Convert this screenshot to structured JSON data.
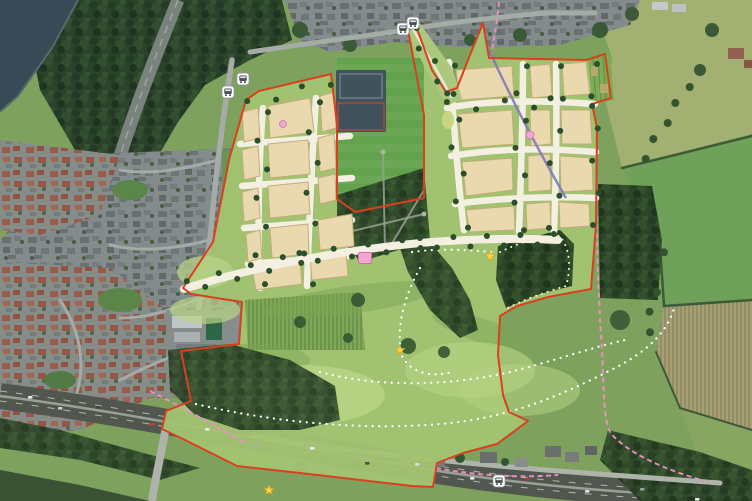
{
  "map": {
    "colors": {
      "site_boundary": "#d8401f",
      "proposed_footpath": "#ffffff",
      "existing_footpath": "#ef8fc2",
      "bridleway": "#8379b8",
      "development_parcel": "#ead9ae",
      "open_space": "#a3c471",
      "street_tree": "#2c4f2b",
      "play_area": "#f0a8d0",
      "viewpoint_star": "#f7d345"
    },
    "markers": {
      "bus_stops": [
        {
          "x": 243,
          "y": 79
        },
        {
          "x": 228,
          "y": 92
        },
        {
          "x": 403,
          "y": 29
        },
        {
          "x": 413,
          "y": 23
        },
        {
          "x": 499,
          "y": 481
        }
      ],
      "viewpoint_stars": [
        {
          "x": 490,
          "y": 256
        },
        {
          "x": 400,
          "y": 350
        },
        {
          "x": 269,
          "y": 490
        }
      ],
      "play_areas": [
        {
          "shape": "square",
          "x": 365,
          "y": 258,
          "w": 13,
          "h": 11
        },
        {
          "shape": "circle",
          "x": 530,
          "y": 135,
          "r": 4
        },
        {
          "shape": "circle",
          "x": 283,
          "y": 124,
          "r": 3.5
        }
      ]
    },
    "tree_lines": [
      {
        "x1": 188,
        "y1": 286,
        "x2": 300,
        "y2": 258,
        "n": 8,
        "s": 5
      },
      {
        "x1": 300,
        "y1": 258,
        "x2": 420,
        "y2": 243,
        "n": 8,
        "s": 5
      },
      {
        "x1": 420,
        "y1": 243,
        "x2": 554,
        "y2": 239,
        "n": 9,
        "s": 5
      },
      {
        "x1": 413,
        "y1": 30,
        "x2": 450,
        "y2": 96,
        "n": 5,
        "s": 4
      },
      {
        "x1": 263,
        "y1": 112,
        "x2": 260,
        "y2": 284,
        "n": 7,
        "s": 5
      },
      {
        "x1": 315,
        "y1": 102,
        "x2": 308,
        "y2": 284,
        "n": 7,
        "s": 5
      },
      {
        "x1": 248,
        "y1": 104,
        "x2": 330,
        "y2": 82,
        "n": 4,
        "s": 3
      },
      {
        "x1": 450,
        "y1": 66,
        "x2": 463,
        "y2": 228,
        "n": 7,
        "s": 5
      },
      {
        "x1": 522,
        "y1": 66,
        "x2": 519,
        "y2": 230,
        "n": 7,
        "s": 5
      },
      {
        "x1": 556,
        "y1": 66,
        "x2": 554,
        "y2": 228,
        "n": 6,
        "s": 5
      },
      {
        "x1": 447,
        "y1": 106,
        "x2": 592,
        "y2": 102,
        "n": 6,
        "s": 4
      },
      {
        "x1": 594,
        "y1": 64,
        "x2": 596,
        "y2": 225,
        "n": 6,
        "s": 3
      },
      {
        "x1": 688,
        "y1": 86,
        "x2": 644,
        "y2": 158,
        "n": 5,
        "s": 2,
        "r": 4,
        "c": "#35532f"
      },
      {
        "x1": 662,
        "y1": 252,
        "x2": 648,
        "y2": 332,
        "n": 5,
        "s": 2,
        "r": 4,
        "c": "#35532f"
      }
    ],
    "cars": [
      {
        "x": 28,
        "y": 399,
        "c": "#e8eae9"
      },
      {
        "x": 58,
        "y": 404,
        "c": "#c8cbca"
      },
      {
        "x": 96,
        "y": 409,
        "c": "#3f4446"
      },
      {
        "x": 150,
        "y": 420,
        "c": "#d23c2e"
      },
      {
        "x": 205,
        "y": 431,
        "c": "#e8eae9"
      },
      {
        "x": 255,
        "y": 440,
        "c": "#aab0ae"
      },
      {
        "x": 310,
        "y": 450,
        "c": "#f0f1f0"
      },
      {
        "x": 365,
        "y": 459,
        "c": "#4a4f52"
      },
      {
        "x": 415,
        "y": 466,
        "c": "#dadcdb"
      },
      {
        "x": 470,
        "y": 474,
        "c": "#e8eae9"
      },
      {
        "x": 525,
        "y": 481,
        "c": "#c0392b"
      },
      {
        "x": 585,
        "y": 487,
        "c": "#dfe1e0"
      },
      {
        "x": 640,
        "y": 491,
        "c": "#9aa09e"
      },
      {
        "x": 695,
        "y": 495,
        "c": "#eceeed"
      }
    ]
  }
}
